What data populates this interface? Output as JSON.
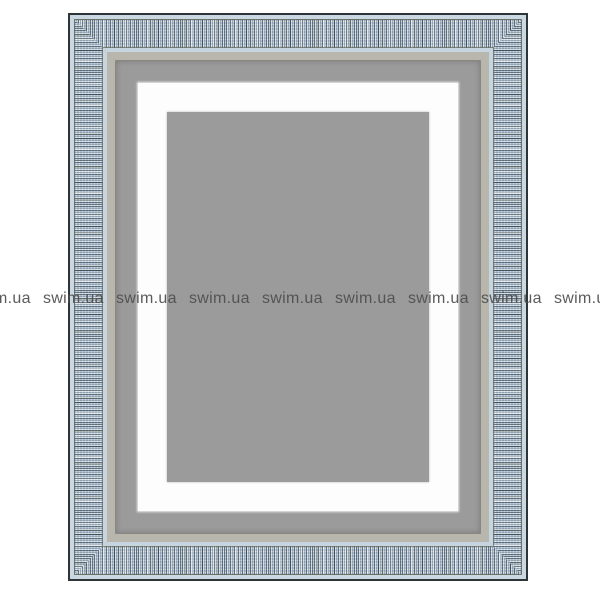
{
  "scene": {
    "description": "Product photo: rectangular wall mirror with inner LED light band, set in a decorative woven blue-grey frame on a white background",
    "background_color": "#ffffff"
  },
  "frame": {
    "outer_border_color": "#2f3437",
    "texture_base_color": "#a9bed0",
    "texture_highlight_color": "#c9d8e2",
    "texture_stroke_color": "#20262c",
    "olive_line_color": "#686c5c",
    "inner_lip_color": "#b8b6ad"
  },
  "mirror": {
    "glass_color": "#9b9b9b",
    "led_band_color": "#fdfdfd"
  },
  "watermark": {
    "text": "swim.ua",
    "repetitions": 9,
    "color": "#4e4e4e",
    "row_top_px": 291,
    "positions_x": [
      -30,
      43,
      116,
      189,
      262,
      335,
      408,
      481,
      554
    ]
  }
}
